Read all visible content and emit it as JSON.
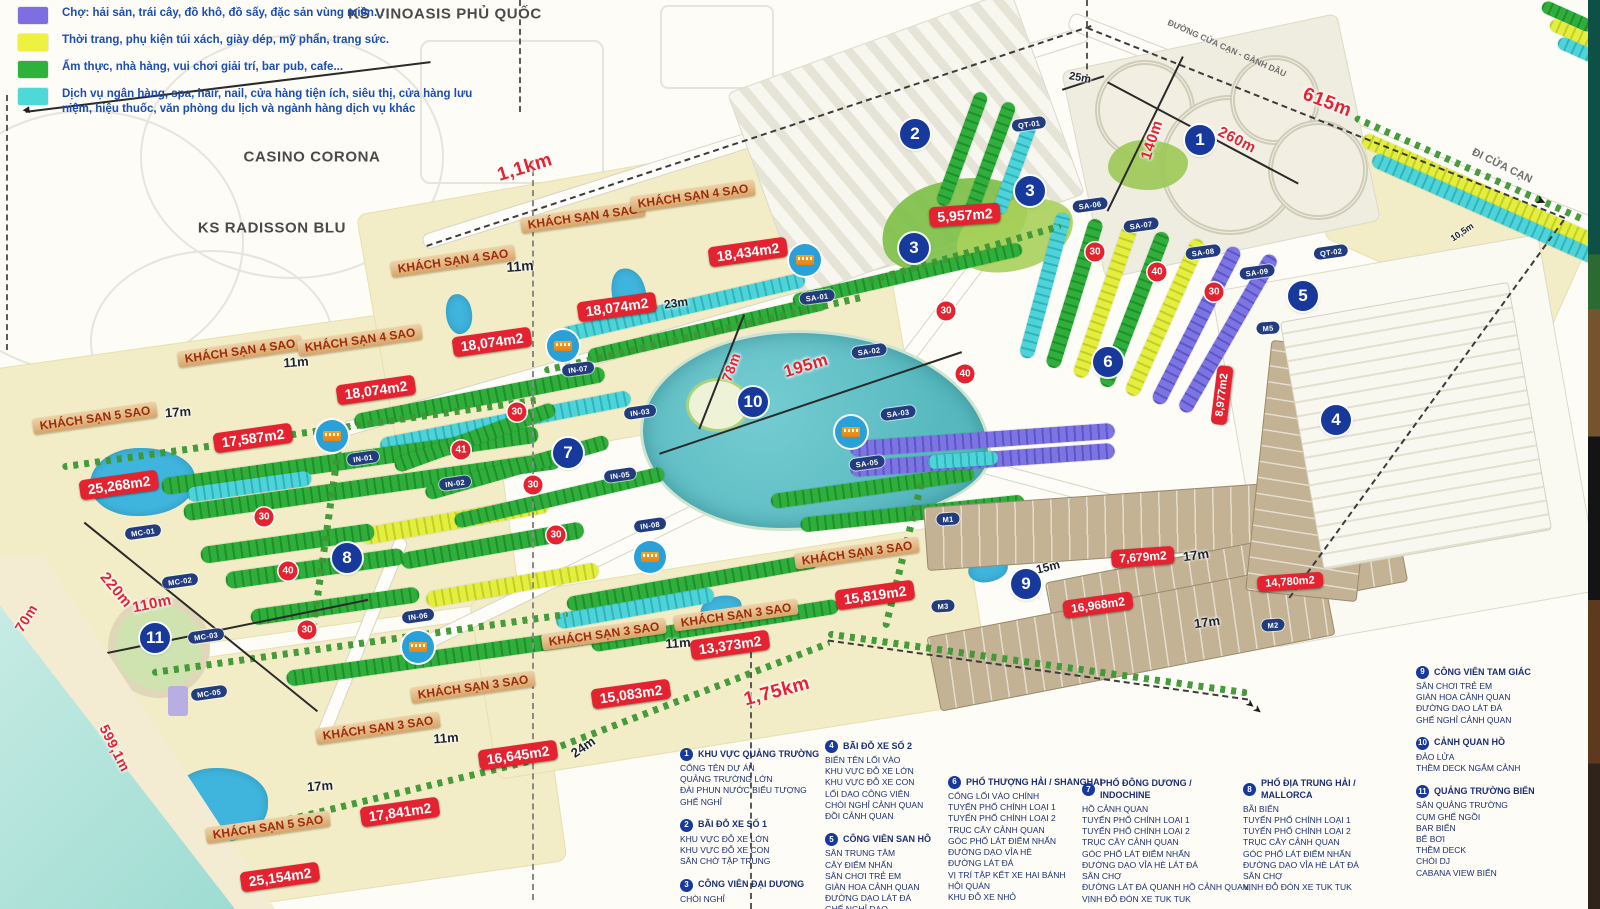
{
  "legend": {
    "items": [
      {
        "color": "#7e6fe0",
        "label": "Chợ: hải sản, trái cây, đồ khô, đồ sấy, đặc sản vùng miền..."
      },
      {
        "color": "#eef23f",
        "label": "Thời trang, phụ kiện túi xách, giày dép, mỹ phẩn, trang sức."
      },
      {
        "color": "#2db33c",
        "label": "Ẩm thực, nhà hàng, vui chơi giải trí, bar pub, cafe..."
      },
      {
        "color": "#4fd8d8",
        "label": "Dịch vụ ngân hàng, spa, hair, nail, cửa hàng tiện ích, siêu thị, cửa hàng lưu niệm, hiệu thuốc, văn phòng du lịch và ngành hàng dịch vụ khác"
      }
    ]
  },
  "overlays": {
    "landmarks": [
      {
        "t": "KS VINOASIS PHỦ QUỐC",
        "x": 445,
        "y": 14
      },
      {
        "t": "CASINO CORONA",
        "x": 312,
        "y": 157
      },
      {
        "t": "KS RADISSON BLU",
        "x": 272,
        "y": 228
      }
    ],
    "road_labels": [
      {
        "t": "ĐƯỜNG CỬA CẠN - GÀNH DẦU",
        "x": 1227,
        "y": 48,
        "r": 24,
        "fs": 8.5
      },
      {
        "t": "ĐI CỬA CẠN",
        "x": 1502,
        "y": 166,
        "r": 26,
        "fs": 11
      }
    ],
    "hotel_labels": [
      {
        "t": "KHÁCH SẠN 4 SAO",
        "x": 240,
        "y": 351,
        "r": -8
      },
      {
        "t": "KHÁCH SẠN 4 SAO",
        "x": 360,
        "y": 340,
        "r": -8
      },
      {
        "t": "KHÁCH SẠN 4 SAO",
        "x": 453,
        "y": 261,
        "r": -8
      },
      {
        "t": "KHÁCH SẠN 4 SAO",
        "x": 583,
        "y": 217,
        "r": -8
      },
      {
        "t": "KHÁCH SẠN 4 SAO",
        "x": 693,
        "y": 196,
        "r": -8
      },
      {
        "t": "KHÁCH SẠN 5 SAO",
        "x": 95,
        "y": 418,
        "r": -8
      },
      {
        "t": "KHÁCH SẠN 5 SAO",
        "x": 268,
        "y": 827,
        "r": -8
      },
      {
        "t": "KHÁCH SẠN 3 SAO",
        "x": 857,
        "y": 553,
        "r": -8
      },
      {
        "t": "KHÁCH SẠN 3 SAO",
        "x": 736,
        "y": 615,
        "r": -8
      },
      {
        "t": "KHÁCH SẠN 3 SAO",
        "x": 604,
        "y": 634,
        "r": -8
      },
      {
        "t": "KHÁCH SẠN 3 SAO",
        "x": 473,
        "y": 687,
        "r": -8
      },
      {
        "t": "KHÁCH SẠN 3 SAO",
        "x": 378,
        "y": 728,
        "r": -8
      }
    ],
    "area_badges": [
      {
        "t": "25,268m2",
        "x": 119,
        "y": 485,
        "r": -8
      },
      {
        "t": "17,587m2",
        "x": 253,
        "y": 438,
        "r": -8
      },
      {
        "t": "18,074m2",
        "x": 376,
        "y": 390,
        "r": -8
      },
      {
        "t": "18,074m2",
        "x": 492,
        "y": 342,
        "r": -8
      },
      {
        "t": "18,074m2",
        "x": 617,
        "y": 307,
        "r": -8
      },
      {
        "t": "18,434m2",
        "x": 748,
        "y": 252,
        "r": -8
      },
      {
        "t": "5,957m2",
        "x": 965,
        "y": 215,
        "r": -4
      },
      {
        "t": "15,819m2",
        "x": 875,
        "y": 595,
        "r": -8
      },
      {
        "t": "13,373m2",
        "x": 730,
        "y": 645,
        "r": -8
      },
      {
        "t": "15,083m2",
        "x": 631,
        "y": 694,
        "r": -8
      },
      {
        "t": "16,645m2",
        "x": 518,
        "y": 755,
        "r": -8
      },
      {
        "t": "17,841m2",
        "x": 400,
        "y": 812,
        "r": -8
      },
      {
        "t": "25,154m2",
        "x": 280,
        "y": 877,
        "r": -8
      },
      {
        "t": "7,679m2",
        "x": 1143,
        "y": 557,
        "r": -4,
        "fs": 12
      },
      {
        "t": "16,968m2",
        "x": 1098,
        "y": 605,
        "r": -8,
        "fs": 12
      },
      {
        "t": "14,780m2",
        "x": 1290,
        "y": 582,
        "r": -4,
        "fs": 11
      },
      {
        "t": "8,977m2",
        "x": 1222,
        "y": 395,
        "r": -83,
        "fs": 11
      }
    ],
    "red_distances": [
      {
        "t": "1,1km",
        "x": 525,
        "y": 168,
        "r": -17,
        "fs": 19
      },
      {
        "t": "615m",
        "x": 1327,
        "y": 103,
        "r": 21,
        "fs": 19
      },
      {
        "t": "140m",
        "x": 1152,
        "y": 140,
        "r": -72,
        "fs": 15
      },
      {
        "t": "260m",
        "x": 1237,
        "y": 140,
        "r": 27,
        "fs": 15
      },
      {
        "t": "195m",
        "x": 806,
        "y": 366,
        "r": -17,
        "fs": 17
      },
      {
        "t": "78m",
        "x": 731,
        "y": 367,
        "r": -70,
        "fs": 14
      },
      {
        "t": "220m",
        "x": 116,
        "y": 590,
        "r": 50,
        "fs": 15
      },
      {
        "t": "110m",
        "x": 152,
        "y": 604,
        "r": -12,
        "fs": 15
      },
      {
        "t": "70m",
        "x": 26,
        "y": 618,
        "r": -58,
        "fs": 14
      },
      {
        "t": "599,1m",
        "x": 115,
        "y": 748,
        "r": 63,
        "fs": 14
      },
      {
        "t": "1,75km",
        "x": 777,
        "y": 692,
        "r": -15,
        "fs": 19
      }
    ],
    "black_distances": [
      {
        "t": "11m",
        "x": 520,
        "y": 266,
        "r": -4,
        "fs": 14
      },
      {
        "t": "11m",
        "x": 296,
        "y": 362,
        "r": -4
      },
      {
        "t": "11m",
        "x": 678,
        "y": 643,
        "r": -4
      },
      {
        "t": "11m",
        "x": 446,
        "y": 738,
        "r": -4
      },
      {
        "t": "17m",
        "x": 178,
        "y": 412,
        "r": -4
      },
      {
        "t": "17m",
        "x": 320,
        "y": 786,
        "r": -4
      },
      {
        "t": "17m",
        "x": 1196,
        "y": 555,
        "r": -8
      },
      {
        "t": "17m",
        "x": 1207,
        "y": 622,
        "r": -8
      },
      {
        "t": "23m",
        "x": 676,
        "y": 303,
        "r": -8,
        "fs": 12
      },
      {
        "t": "24m",
        "x": 583,
        "y": 747,
        "r": -35
      },
      {
        "t": "25m",
        "x": 1080,
        "y": 78,
        "r": 10,
        "fs": 11
      },
      {
        "t": "15m",
        "x": 1048,
        "y": 567,
        "r": -14,
        "fs": 12
      },
      {
        "t": "10,5m",
        "x": 1462,
        "y": 232,
        "r": -34,
        "fs": 9
      }
    ],
    "markers": [
      {
        "t": "1",
        "x": 1200,
        "y": 140
      },
      {
        "t": "2",
        "x": 915,
        "y": 134
      },
      {
        "t": "3",
        "x": 1030,
        "y": 191
      },
      {
        "t": "3",
        "x": 914,
        "y": 248
      },
      {
        "t": "4",
        "x": 1336,
        "y": 420
      },
      {
        "t": "5",
        "x": 1303,
        "y": 296
      },
      {
        "t": "6",
        "x": 1108,
        "y": 362
      },
      {
        "t": "7",
        "x": 568,
        "y": 453
      },
      {
        "t": "8",
        "x": 347,
        "y": 558
      },
      {
        "t": "9",
        "x": 1026,
        "y": 584
      },
      {
        "t": "10",
        "x": 753,
        "y": 402
      },
      {
        "t": "11",
        "x": 155,
        "y": 638
      }
    ],
    "mini_markers": [
      {
        "t": "30",
        "x": 1095,
        "y": 252
      },
      {
        "t": "40",
        "x": 1157,
        "y": 272
      },
      {
        "t": "30",
        "x": 1214,
        "y": 292
      },
      {
        "t": "30",
        "x": 946,
        "y": 311
      },
      {
        "t": "40",
        "x": 965,
        "y": 374
      },
      {
        "t": "30",
        "x": 517,
        "y": 412
      },
      {
        "t": "41",
        "x": 461,
        "y": 450
      },
      {
        "t": "30",
        "x": 533,
        "y": 485
      },
      {
        "t": "30",
        "x": 556,
        "y": 535
      },
      {
        "t": "30",
        "x": 264,
        "y": 517
      },
      {
        "t": "40",
        "x": 288,
        "y": 571
      },
      {
        "t": "30",
        "x": 307,
        "y": 630
      }
    ],
    "tags": [
      {
        "t": "QT-01",
        "x": 1029,
        "y": 124,
        "r": -8
      },
      {
        "t": "QT-02",
        "x": 1331,
        "y": 252,
        "r": -8
      },
      {
        "t": "SA-01",
        "x": 817,
        "y": 297,
        "r": -8
      },
      {
        "t": "SA-02",
        "x": 869,
        "y": 351,
        "r": -8
      },
      {
        "t": "SA-03",
        "x": 898,
        "y": 413,
        "r": -8
      },
      {
        "t": "SA-05",
        "x": 867,
        "y": 463,
        "r": -8
      },
      {
        "t": "SA-06",
        "x": 1090,
        "y": 205,
        "r": -8
      },
      {
        "t": "SA-07",
        "x": 1141,
        "y": 225,
        "r": -8
      },
      {
        "t": "SA-08",
        "x": 1203,
        "y": 252,
        "r": -8
      },
      {
        "t": "SA-09",
        "x": 1257,
        "y": 272,
        "r": -8
      },
      {
        "t": "IN-01",
        "x": 363,
        "y": 458,
        "r": -8
      },
      {
        "t": "IN-02",
        "x": 455,
        "y": 483,
        "r": -8
      },
      {
        "t": "IN-03",
        "x": 640,
        "y": 412,
        "r": -8
      },
      {
        "t": "IN-05",
        "x": 620,
        "y": 475,
        "r": -8
      },
      {
        "t": "IN-06",
        "x": 418,
        "y": 616,
        "r": -8
      },
      {
        "t": "IN-07",
        "x": 578,
        "y": 369,
        "r": -8
      },
      {
        "t": "IN-08",
        "x": 650,
        "y": 525,
        "r": -8
      },
      {
        "t": "MC-01",
        "x": 143,
        "y": 532,
        "r": -8
      },
      {
        "t": "MC-02",
        "x": 180,
        "y": 581,
        "r": -8
      },
      {
        "t": "MC-03",
        "x": 206,
        "y": 636,
        "r": -8
      },
      {
        "t": "MC-05",
        "x": 209,
        "y": 693,
        "r": -8
      },
      {
        "t": "M1",
        "x": 948,
        "y": 519,
        "r": -4
      },
      {
        "t": "M2",
        "x": 1273,
        "y": 625,
        "r": -4
      },
      {
        "t": "M3",
        "x": 943,
        "y": 606,
        "r": -4
      },
      {
        "t": "M5",
        "x": 1268,
        "y": 328,
        "r": -4
      }
    ],
    "bus_stops": [
      {
        "x": 332,
        "y": 436
      },
      {
        "x": 563,
        "y": 346
      },
      {
        "x": 805,
        "y": 260
      },
      {
        "x": 851,
        "y": 432
      },
      {
        "x": 650,
        "y": 557
      },
      {
        "x": 418,
        "y": 647
      }
    ],
    "arrows": [
      {
        "t": "➤",
        "x": 1541,
        "y": 201,
        "r": 24,
        "fs": 13
      },
      {
        "t": "➤➤",
        "x": 1254,
        "y": 707,
        "r": 38,
        "fs": 11
      },
      {
        "t": "◀",
        "x": 26,
        "y": 110,
        "r": -7,
        "fs": 9
      }
    ]
  },
  "bottom_legend": {
    "columns": [
      {
        "x": 680,
        "y": 748,
        "items": [
          {
            "num": "1",
            "title": "KHU VỰC QUẢNG TRƯỜNG",
            "lines": [
              "CỔNG TÊN DỰ ÁN",
              "QUẢNG TRƯỜNG LỚN",
              "ĐÀI PHUN NƯỚC BIỂU TƯỢNG",
              "GHẾ NGHỈ"
            ]
          },
          {
            "num": "2",
            "title": "BÃI ĐỖ XE SỐ 1",
            "lines": [
              "KHU VỰC ĐỖ XE LỚN",
              "KHU VỰC ĐỖ XE CON",
              "SÂN CHỜ TẬP TRUNG"
            ]
          },
          {
            "num": "3",
            "title": "CÔNG VIÊN ĐẠI DƯƠNG",
            "lines": [
              "CHÒI NGHỈ"
            ]
          }
        ]
      },
      {
        "x": 825,
        "y": 740,
        "items": [
          {
            "num": "4",
            "title": "BÃI ĐỖ XE SỐ 2",
            "lines": [
              "BIỂN TÊN LỐI VÀO",
              "KHU VỰC ĐỖ XE LỚN",
              "KHU VỰC ĐỖ XE CON",
              "LỐI DẠO CÔNG VIÊN",
              "CHÒI NGHỈ CẢNH QUAN",
              "ĐỒI CẢNH QUAN"
            ]
          },
          {
            "num": "5",
            "title": "CÔNG VIÊN SAN HÔ",
            "lines": [
              "SÂN TRUNG TÂM",
              "CÂY ĐIỂM NHẤN",
              "SÂN CHƠI TRẺ EM",
              "GIÀN HOA CẢNH QUAN",
              "ĐƯỜNG DẠO LÁT ĐÁ",
              "GHẾ NGHỈ DẠO"
            ]
          }
        ]
      },
      {
        "x": 948,
        "y": 776,
        "items": [
          {
            "num": "6",
            "title": "PHỐ THƯỢNG HẢI / SHANGHAI",
            "lines": [
              "CỔNG LỐI VÀO CHÍNH",
              "TUYẾN PHỐ CHÍNH LOẠI 1",
              "TUYẾN PHỐ CHÍNH LOẠI 2",
              "TRỤC CÂY CẢNH QUAN",
              "GÓC PHỐ LÁT ĐIỂM NHẤN",
              "ĐƯỜNG DẠO VỈA HÈ",
              "ĐƯỜNG LÁT ĐÁ",
              "VỊ TRÍ TẬP KẾT XE HAI BÁNH",
              "HỘI QUÁN",
              "KHU ĐỖ XE NHỎ"
            ]
          }
        ]
      },
      {
        "x": 1082,
        "y": 778,
        "items": [
          {
            "num": "7",
            "title": "PHỐ ĐÔNG DƯƠNG / INDOCHINE",
            "lines": [
              "HỒ CẢNH QUAN",
              "TUYẾN PHỐ CHÍNH LOẠI 1",
              "TUYẾN PHỐ CHÍNH LOẠI 2",
              "TRỤC CÂY CẢNH QUAN",
              "GÓC PHỐ LÁT ĐIỂM NHẤN",
              "ĐƯỜNG DẠO VỈA HÈ LÁT ĐÁ",
              "SÂN CHỢ",
              "ĐƯỜNG LÁT ĐÁ QUANH HỒ CẢNH QUAN",
              "VỊNH ĐỖ ĐÓN XE TUK TUK"
            ]
          }
        ]
      },
      {
        "x": 1243,
        "y": 778,
        "items": [
          {
            "num": "8",
            "title": "PHỐ ĐỊA TRUNG HẢI / MALLORCA",
            "lines": [
              "BÃI BIỂN",
              "TUYẾN PHỐ CHÍNH LOẠI 1",
              "TUYẾN PHỐ CHÍNH LOẠI 2",
              "TRỤC CÂY CẢNH QUAN",
              "GÓC PHỐ LÁT ĐIỂM NHẤN",
              "ĐƯỜNG DẠO VỈA HÈ LÁT ĐÁ",
              "SÂN CHỢ",
              "VỊNH ĐỖ ĐÓN XE TUK TUK"
            ]
          }
        ]
      },
      {
        "x": 1416,
        "y": 666,
        "items": [
          {
            "num": "9",
            "title": "CÔNG VIÊN TAM GIÁC",
            "lines": [
              "SÂN CHƠI TRẺ EM",
              "GIÀN HOA CẢNH QUAN",
              "ĐƯỜNG DẠO LÁT ĐÁ",
              "GHẾ NGHỈ CẢNH QUAN"
            ]
          },
          {
            "num": "10",
            "title": "CẢNH QUAN HỒ",
            "lines": [
              "ĐẢO LỬA",
              "THỀM DECK NGẮM CẢNH"
            ]
          },
          {
            "num": "11",
            "title": "QUẢNG TRƯỜNG BIỂN",
            "lines": [
              "SÂN QUẢNG TRƯỜNG",
              "CỤM GHẾ NGỒI",
              "BAR BIỂN",
              "BỂ BƠI",
              "THỀM DECK",
              "CHÒI DJ",
              "CABANA VIEW BIỂN"
            ]
          }
        ]
      }
    ]
  }
}
